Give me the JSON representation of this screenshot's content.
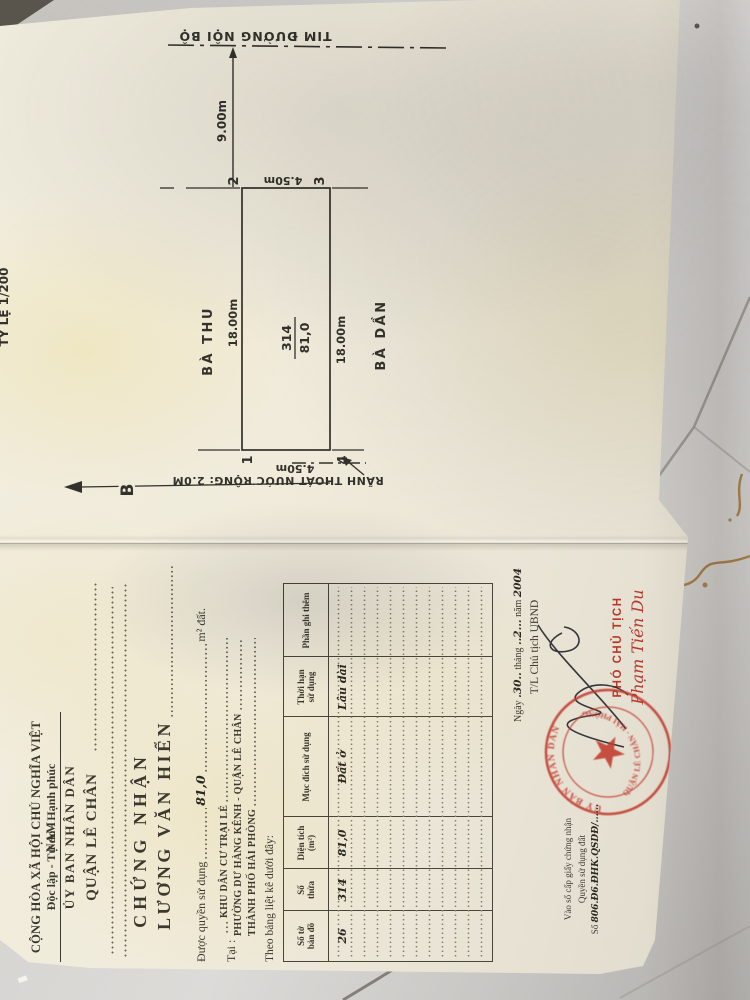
{
  "certificate": {
    "national_line1": "CỘNG HÒA XÃ HỘI CHỦ NGHĨA VIỆT NAM",
    "national_line2": "Độc lập - Tự do - Hạnh phúc",
    "issuer": "ỦY BAN NHÂN DÂN",
    "issuer_name": "QUẬN LÊ CHÂN",
    "certify_title": "CHỨNG NHẬN",
    "grantee": "LƯƠNG VĂN HIỂN",
    "grant_prefix": "Được quyền sử dụng",
    "grant_area": "81,0",
    "grant_unit": "m² đất.",
    "at_label": "Tại :",
    "at_line1": "KHU DÂN CƯ TRẠI LẺ",
    "at_line2": "PHƯỜNG DƯ HÀNG KÊNH - QUẬN LÊ CHÂN",
    "at_line3": "THÀNH PHỐ HẢI PHÒNG",
    "table_intro": "Theo bảng liệt kê dưới đây:",
    "table": {
      "headers": [
        "Số tờ\nbản đồ",
        "Số\nthửa",
        "Diện tích\n(m²)",
        "Mục đích sử dụng",
        "Thời hạn\nsử dụng",
        "Phần ghi thêm"
      ],
      "row": [
        "26",
        "314",
        "81,0",
        "Đất ở",
        "Lâu dài",
        ""
      ]
    },
    "signing": {
      "ngay_label": "Ngày",
      "day": ".30..",
      "thang_label": "tháng",
      "month": "..2...",
      "nam_label": "năm",
      "year": "2004",
      "on_behalf": "T/L Chủ tịch UBND",
      "position": "PHÓ CHỦ TỊCH",
      "signer": "Phạm Tiến Du"
    },
    "stamp": {
      "arc_top": "UỶ BAN NHÂN DÂN",
      "arc_bottom": "QUẬN LÊ CHÂN ∙ HẢI PHÒNG"
    },
    "registry": {
      "line1": "Vào sổ cấp giấy chứng nhận",
      "line2": "Quyền sử dụng đất",
      "so_label": "Số",
      "so_value": "806.Đ6.ĐHK.QSDĐ/......"
    }
  },
  "diagram": {
    "scale_note": "TỶ LỆ 1/200",
    "road_label": "TIM ĐƯỜNG NỘI BỘ",
    "road_distance": "9.00m",
    "north_label": "B",
    "parcel_number": "314",
    "parcel_area": "81,0",
    "dim_top": "18.00m",
    "dim_bottom": "18.00m",
    "dim_left": "4.50m",
    "dim_right": "4.50m",
    "corner_1": "1",
    "corner_2": "2",
    "corner_3": "3",
    "corner_4": "4",
    "neighbor_top": "BÀ THU",
    "neighbor_bottom": "BÀ DẦN",
    "ditch_label": "RÃNH THOÁT NƯỚC RỘNG: 2.0M"
  }
}
